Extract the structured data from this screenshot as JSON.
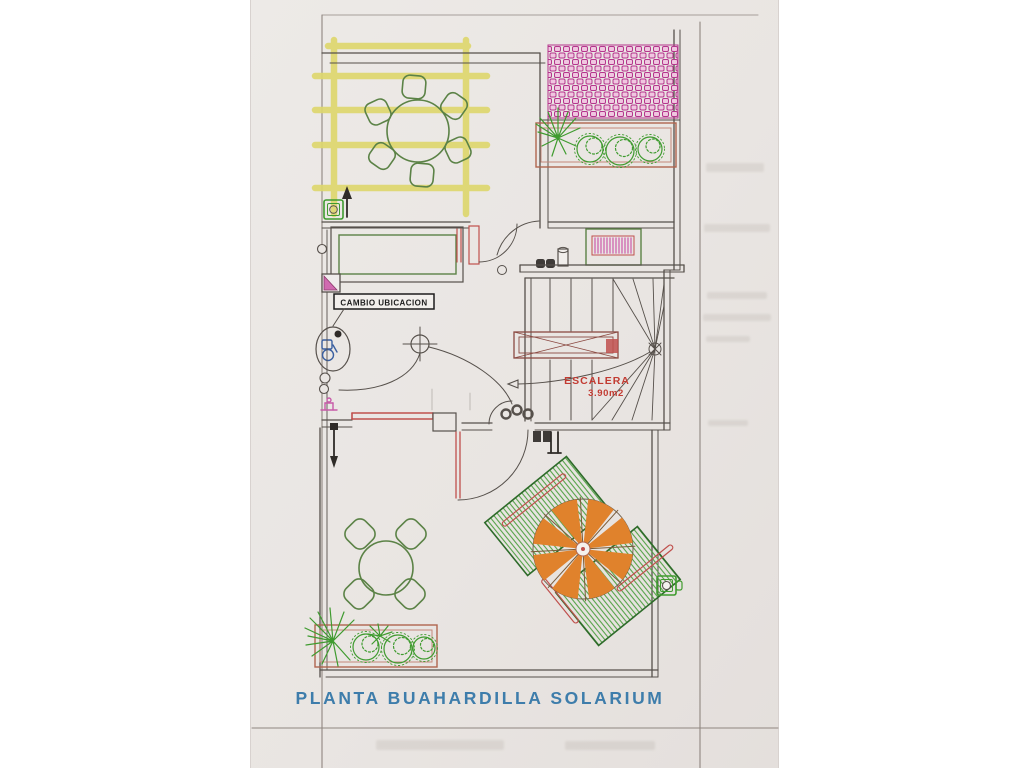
{
  "document": {
    "kind": "scanned floor plan drawing",
    "title": "PLANTA BUAHARDILLA SOLARIUM"
  },
  "labels": {
    "change_location": "CAMBIO UBICACION",
    "stair_name": "ESCALERA",
    "stair_area": "3.90m2"
  },
  "colors": {
    "paper": "#e9e5e2",
    "ink": "#56504b",
    "pergola_yellow": "#ded76e",
    "plant_green": "#3f9b2f",
    "furniture_green": "#5b8246",
    "tile_pink": "#b5368d",
    "tile_pink_fill": "#f0c6e0",
    "planter_brown": "#b0654f",
    "accent_red": "#c0504d",
    "stair_label_red": "#c23b32",
    "parasol_orange": "#e0822c",
    "title_blue": "#3e7dab",
    "fixture_blue": "#3a5fa0"
  },
  "features": [
    "pergola",
    "outdoor-dining-table-6-chairs",
    "tiled-roof-hatch",
    "planter-palms-shrubs",
    "radiator",
    "double-door",
    "staircase",
    "bathroom-relocation-callout",
    "window",
    "solarium-terrace",
    "outdoor-dining-table-4-chairs",
    "sun-loungers",
    "parasol",
    "floor-drain"
  ]
}
